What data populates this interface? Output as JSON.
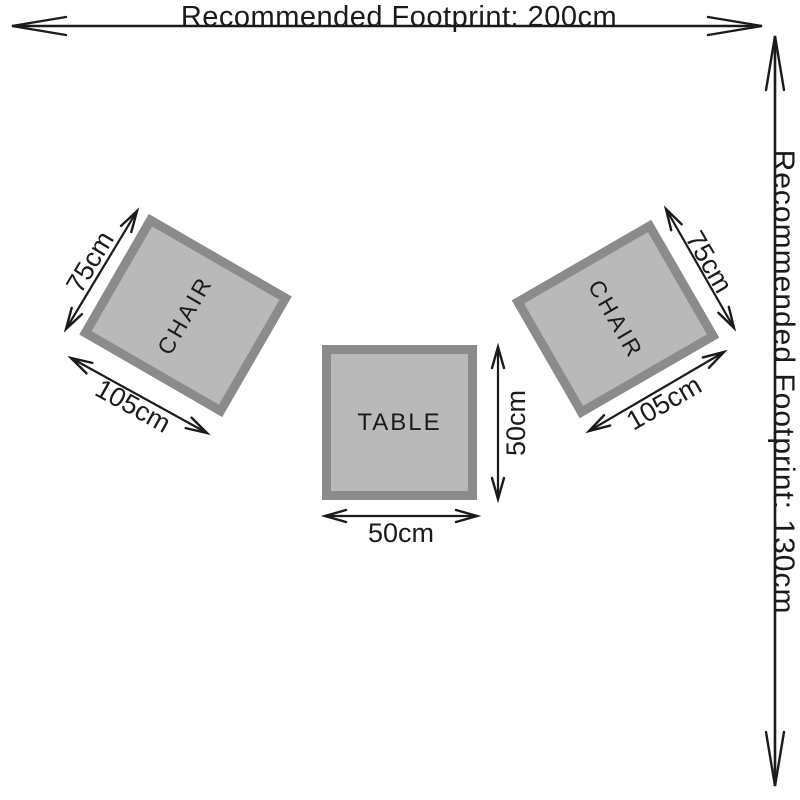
{
  "diagram": {
    "footprint": {
      "width": "Recommended Footprint: 200cm",
      "height": "Recommended Footprint: 130cm"
    },
    "table": {
      "label": "TABLE",
      "width": "50cm",
      "depth": "50cm"
    },
    "left_chair": {
      "label": "CHAIR",
      "depth": "75cm",
      "width": "105cm"
    },
    "right_chair": {
      "label": "CHAIR",
      "depth": "75cm",
      "width": "105cm"
    }
  },
  "colors": {
    "background": "#ffffff",
    "line_color": "#1b1b1b",
    "furniture_fill": "#b9b9b9",
    "furniture_border": "#8b8b8b"
  }
}
